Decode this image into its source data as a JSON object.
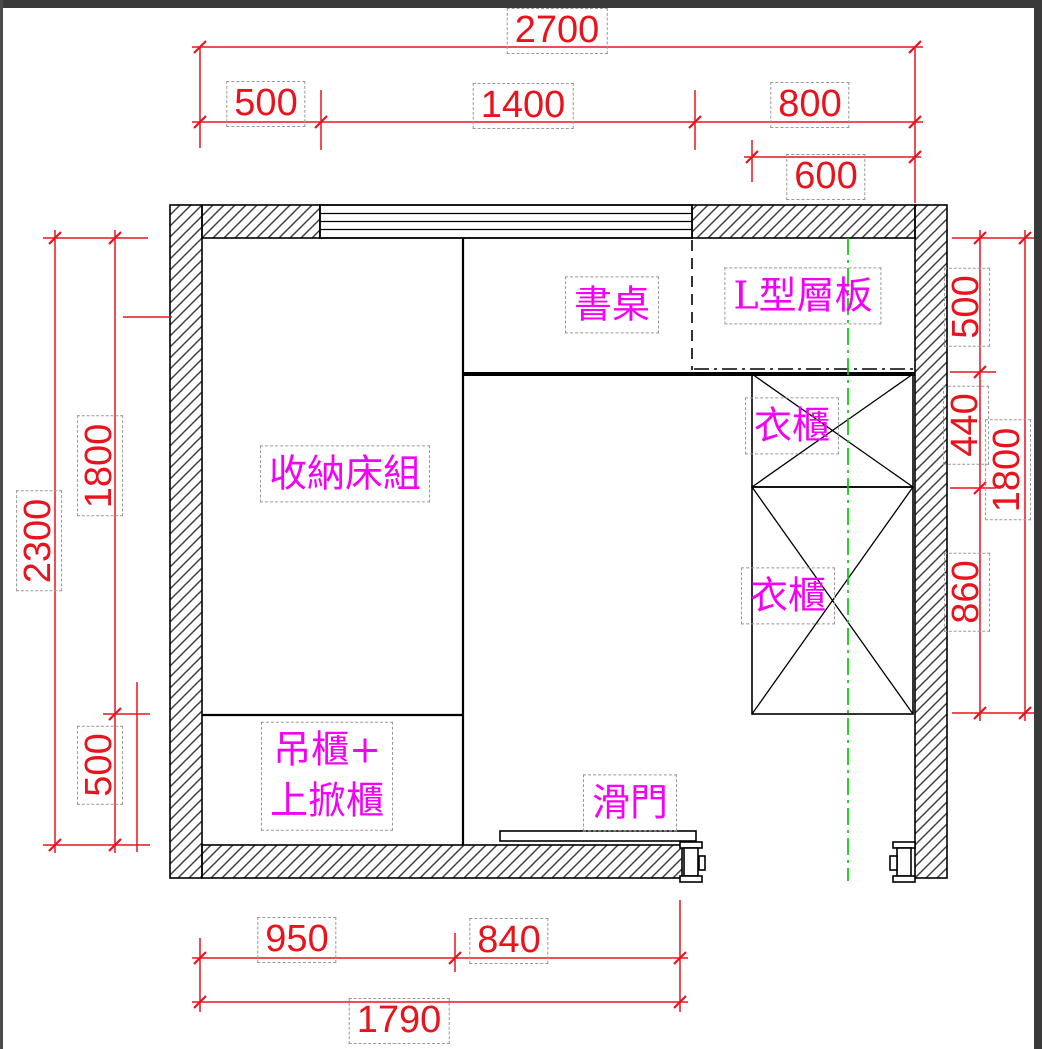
{
  "drawing_type": "room furniture floor plan (CAD)",
  "dims": {
    "top_total": "2700",
    "top_seg1": "500",
    "top_seg2": "1400",
    "top_seg3": "800",
    "top_wardrobe_width": "600",
    "left_total": "2300",
    "left_seg1": "1800",
    "left_seg2": "500",
    "right_seg1": "500",
    "right_seg2": "440",
    "right_seg3": "860",
    "right_total": "1800",
    "bottom_seg1": "950",
    "bottom_seg2": "840",
    "bottom_total": "1790"
  },
  "labels": {
    "storage_bed": "收納床組",
    "desk": "書桌",
    "l_shaped_shelf": "L型層板",
    "wardrobe_upper": "衣櫃",
    "wardrobe_lower": "衣櫃",
    "hanging_cabinet_line1": "吊櫃+",
    "hanging_cabinet_line2": "上掀櫃",
    "sliding_door": "滑門"
  },
  "colors": {
    "dimension_red": "#e8131d",
    "label_magenta": "#f400f4",
    "centerline_green": "#00cc00",
    "line_black": "#000000",
    "hatch_gray": "#3f3f3f",
    "chrome_dark": "#3a3a3a"
  }
}
